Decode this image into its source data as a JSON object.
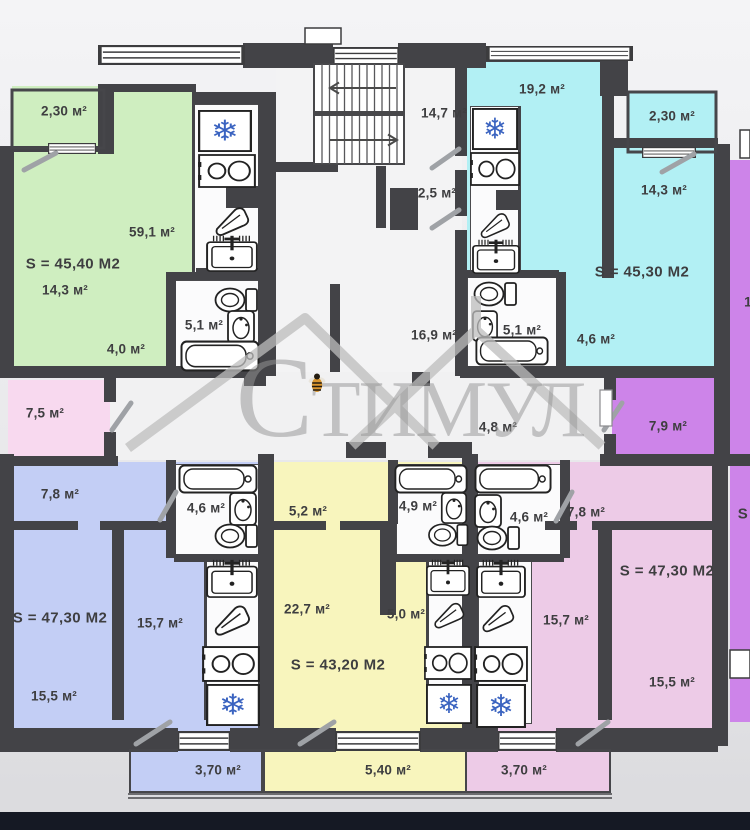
{
  "watermark": {
    "text": "Стимул"
  },
  "colors": {
    "wall": "#434347",
    "green": "#cfeec0",
    "cyan": "#b2f0f4",
    "blue": "#c3cef5",
    "yellow": "#f8f5bd",
    "pink": "#edcbe7",
    "light_pink": "#f8d9ef",
    "purple": "#cd84e9",
    "snowflake_blue": "#3a63c0",
    "page_bottom_bar": "#151924"
  },
  "common_areas": {
    "stair_hall": "14,7 м²",
    "lift": "2,5 м²",
    "corridor": "16,9 м²",
    "entry_hall": "4,8 м²",
    "left_room": "7,5 м²",
    "right_room": "7,9 м²"
  },
  "apartments": {
    "green": {
      "total": "S = 45,40 М2",
      "balcony": "2,30 м²",
      "living": "59,1 м²",
      "bedroom": "14,3 м²",
      "hall": "4,0 м²",
      "bathroom": "5,1 м²"
    },
    "cyan": {
      "total": "S = 45,30 М2",
      "kitchen_living": "19,2 м²",
      "balcony": "2,30 м²",
      "bedroom": "14,3 м²",
      "bathroom": "5,1 м²",
      "hall": "4,6 м²"
    },
    "blue": {
      "total": "S = 47,30 М2",
      "room": "7,8 м²",
      "bathroom": "4,6 м²",
      "kitchen": "15,7 м²",
      "bedroom": "15,5 м²",
      "balcony": "3,70 м²"
    },
    "yellow": {
      "total": "S = 43,20 М2",
      "hall": "5,2 м²",
      "bathroom": "4,9 м²",
      "living": "22,7 м²",
      "kitchen": "5,0 м²",
      "balcony": "5,40 м²"
    },
    "pink": {
      "total": "S = 47,30 М2",
      "bathroom": "4,6 м²",
      "room": "7,8 м²",
      "kitchen": "15,7 м²",
      "bedroom": "15,5 м²",
      "balcony": "3,70 м²"
    },
    "right_cut": {
      "total": "S",
      "room": "1"
    }
  },
  "icons": {
    "fridge_glyph": "❄"
  }
}
